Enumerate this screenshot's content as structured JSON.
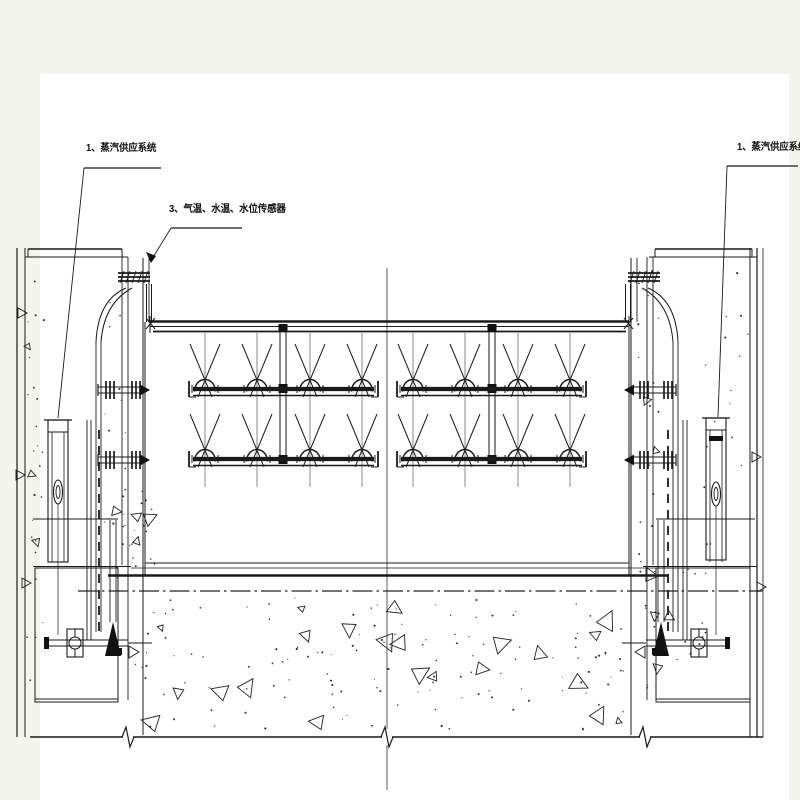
{
  "canvas": {
    "background": "#f4f5ed",
    "sheet_color": "#fefefe",
    "ink_color": "#1a1a1a"
  },
  "labels": {
    "steam_left": {
      "text": "1、蒸汽供应系统"
    },
    "sensors": {
      "text": "3、气温、水温、水位传感器"
    },
    "steam_right": {
      "text": "1、蒸汽供应系统"
    }
  },
  "figure": {
    "type": "engineering-section-drawing",
    "heater_rows": 2,
    "heater_groups": 2,
    "heaters_per_group_per_row": 4,
    "piers": 2
  }
}
